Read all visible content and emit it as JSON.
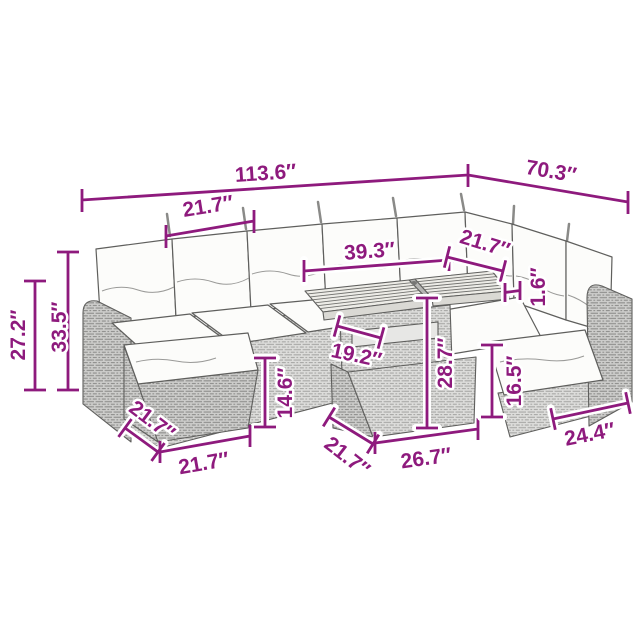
{
  "figure_title": "rattan-garden-furniture-set-dimension-diagram",
  "colors": {
    "dimension": "#8e1a7d",
    "outline": "#5f5f5d",
    "cushion": "#fcfcfa",
    "wicker_light": "#dddddb",
    "wicker_dark": "#cdcdcb",
    "wood": "#edece7",
    "background": "#ffffff"
  },
  "dimensions": {
    "overall_width": "113.6″",
    "right_section_width": "70.3″",
    "seat_module_width": "21.7″",
    "tabletop_length": "39.3″",
    "right_seat_width": "21.7″",
    "tabletop_thickness": "1.6″",
    "armrest_height": "27.2″",
    "backrest_height": "33.5″",
    "ottoman_height": "14.6″",
    "ottoman_depth": "21.7″",
    "ottoman_width": "21.7″",
    "table_depth": "21.7″",
    "table_width": "26.7″",
    "table_height": "28.7″",
    "table_inner_width": "19.2″",
    "seat_height": "16.5″",
    "end_module_depth": "24.4″"
  }
}
